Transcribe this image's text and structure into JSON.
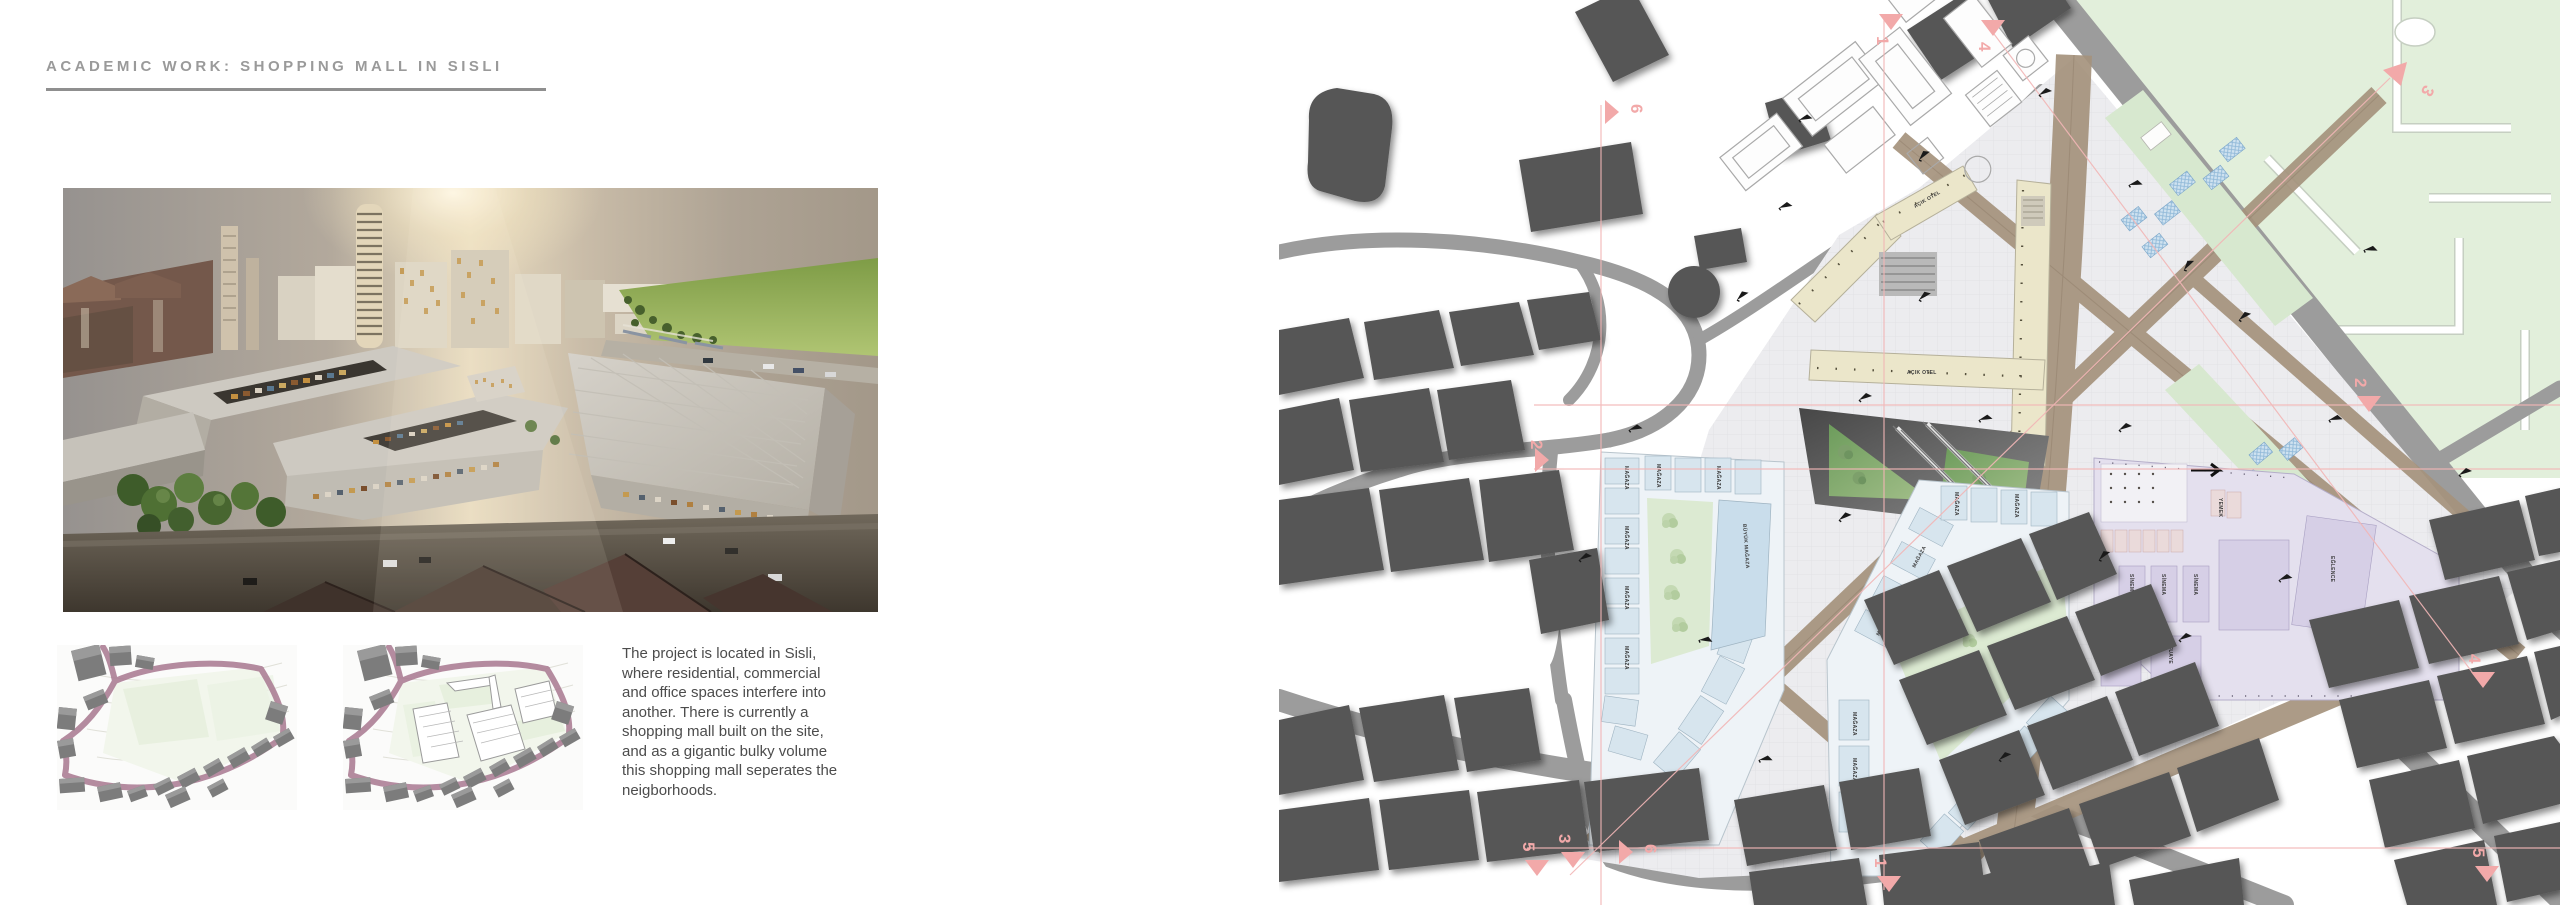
{
  "page": {
    "title": "ACADEMIC WORK: SHOPPING MALL IN SISLI"
  },
  "description": {
    "lines": [
      "The project is located in Sisli,",
      "where residential, commercial",
      "and office spaces interfere into",
      "another. There is currently a",
      "shopping mall built on the site,",
      "and as a gigantic bulky volume",
      "this shopping mall seperates the",
      "neigborhoods."
    ]
  },
  "plan": {
    "shop_label": "MAĞAZA",
    "big_store_label": "BÜYÜK MAĞAZA",
    "hotel_label": "AÇIK OTEL",
    "cinema_label": "SİNEMA",
    "foyer_label": "FUAYE",
    "entertainment_label": "EĞLENCE",
    "food_label": "YEMEK",
    "section_markers": {
      "m1": "1",
      "m2": "2",
      "m3": "3",
      "m4": "4",
      "m5": "5",
      "m6": "6"
    },
    "colors": {
      "accent_pink": "#f2a9a9",
      "park_green": "#e2efdb",
      "shop_blue": "#d7e5ee",
      "hotel_cream": "#ebe6ca",
      "cinema_lavender": "#ddd8ea",
      "path_tan": "#a5937d",
      "building_dark": "#575757",
      "road_gray": "#9c9c9c",
      "courtyard_green": "#dcead2"
    }
  }
}
